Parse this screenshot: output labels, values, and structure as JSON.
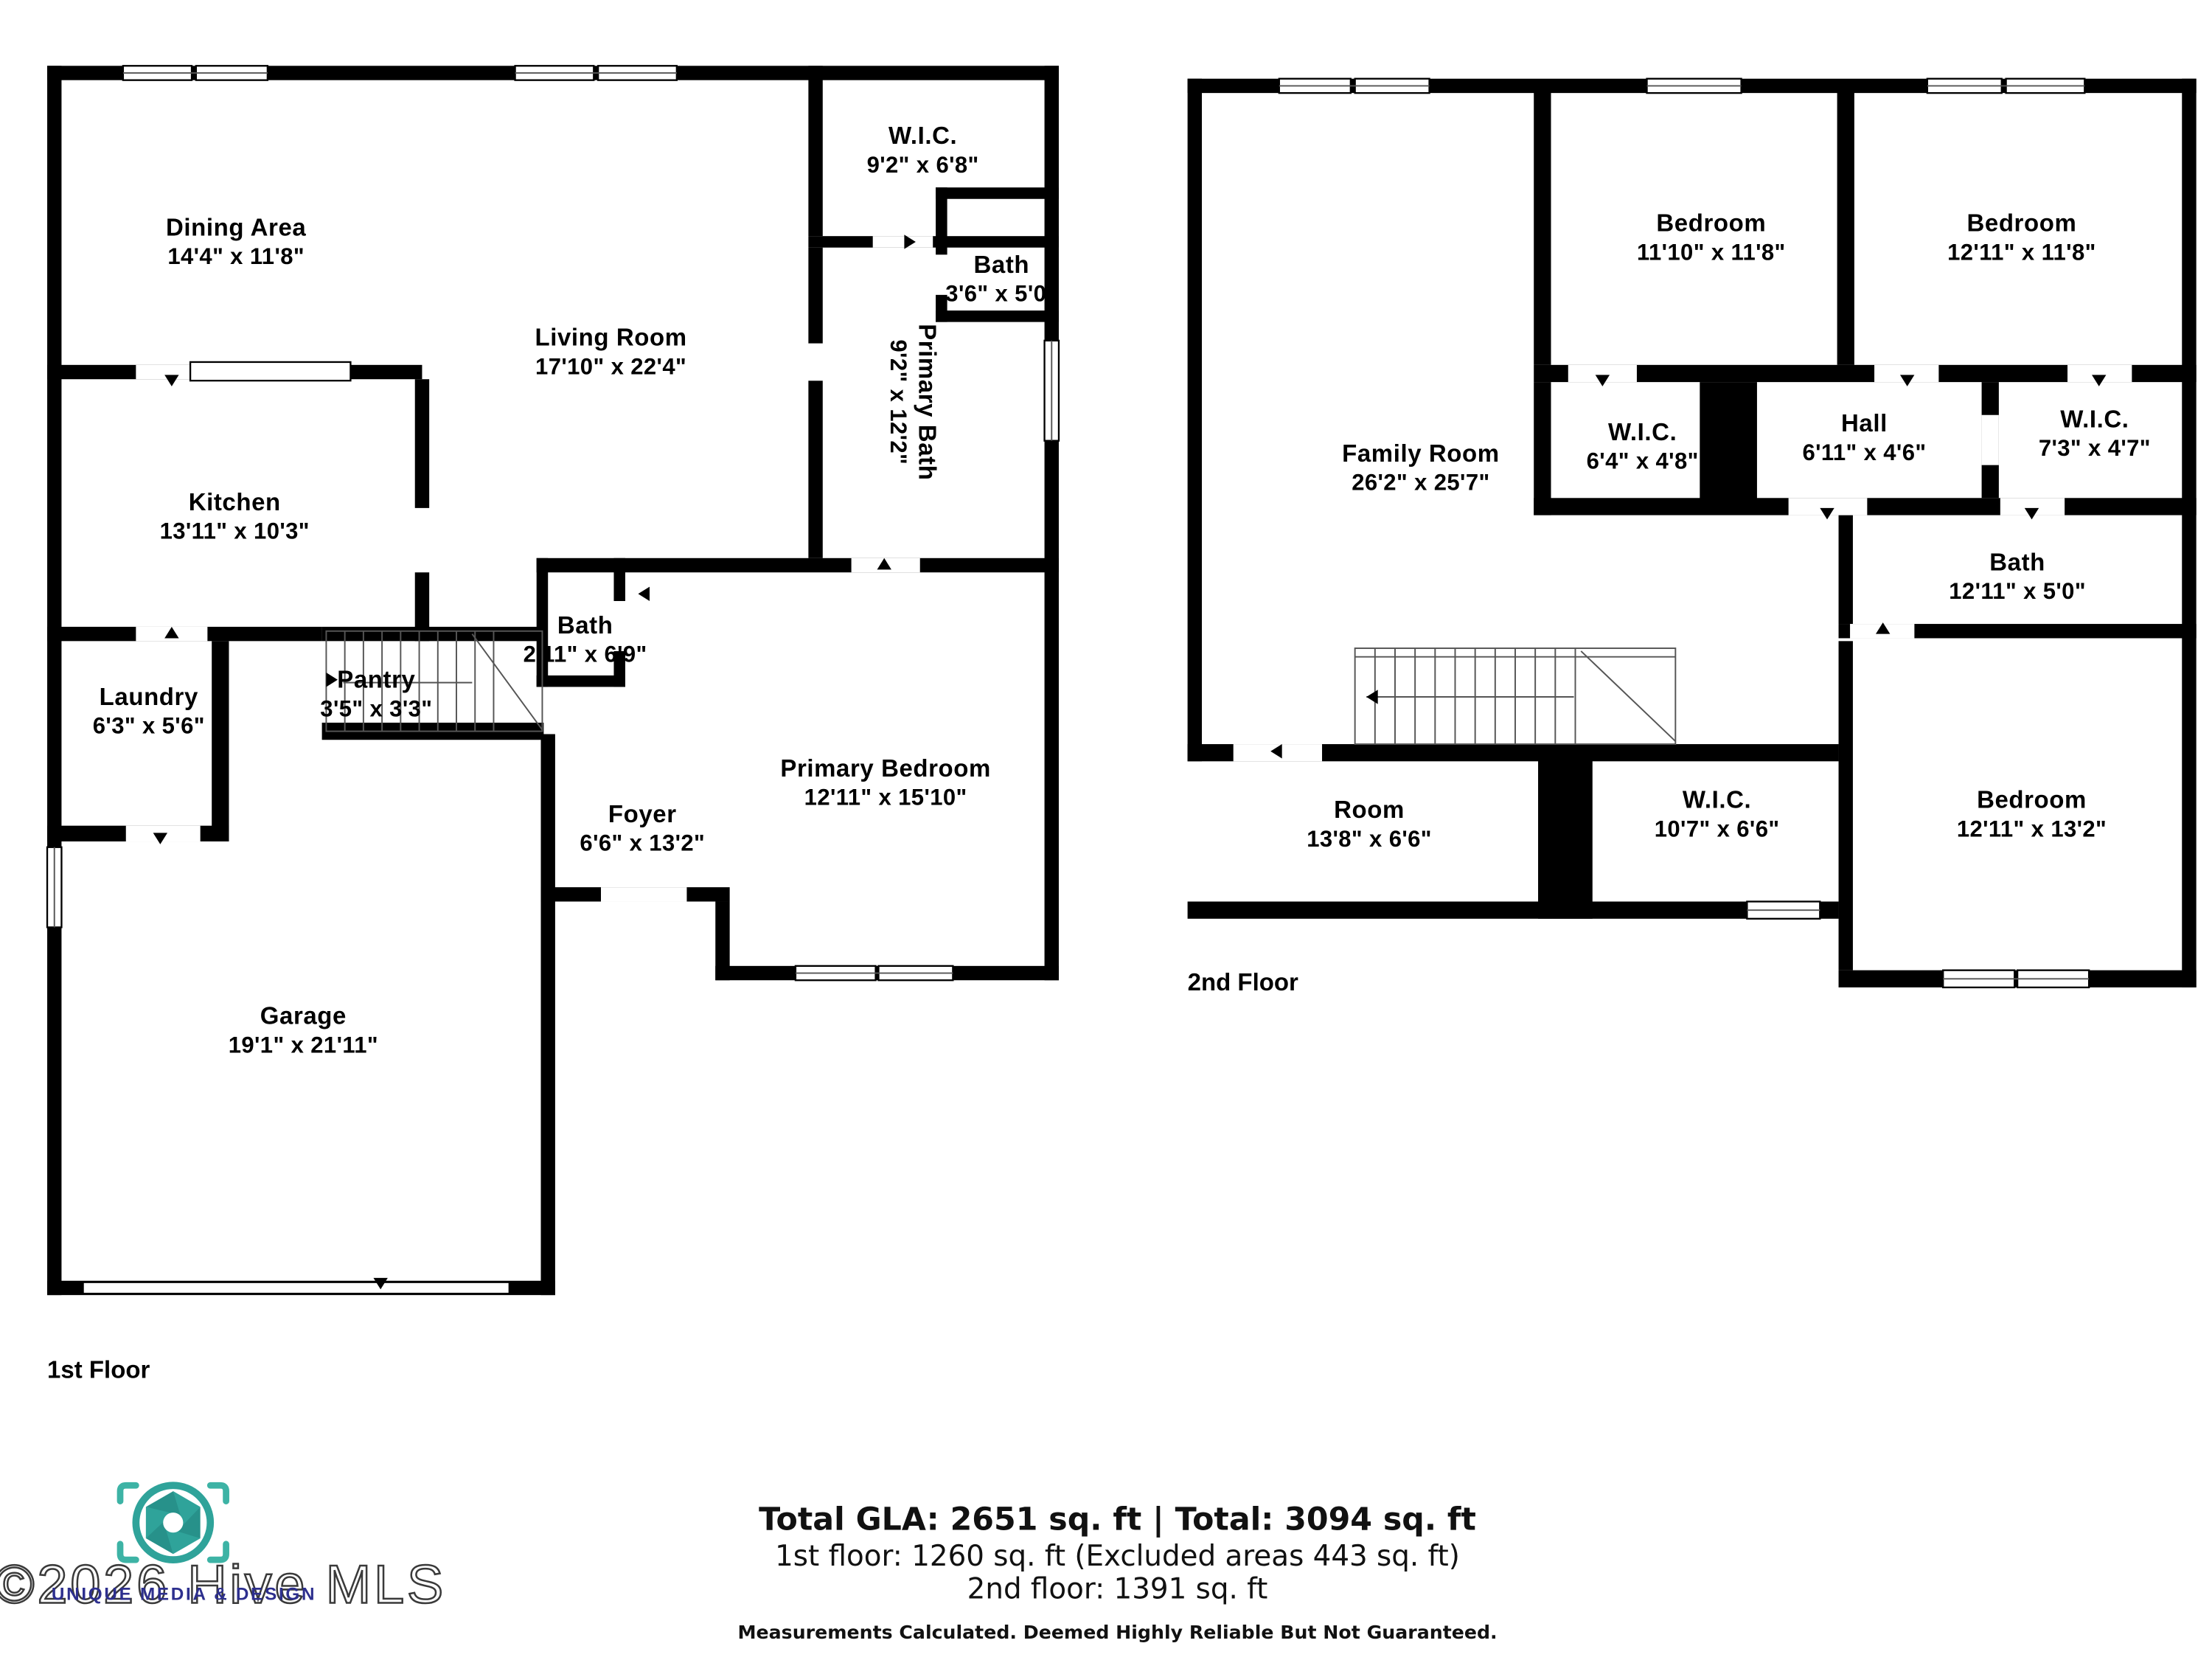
{
  "floors": [
    {
      "label": "1st Floor",
      "rooms": [
        {
          "name": "Dining Area",
          "dims": "14'4\" x 11'8\""
        },
        {
          "name": "Living Room",
          "dims": "17'10\" x 22'4\""
        },
        {
          "name": "W.I.C.",
          "dims": "9'2\" x 6'8\""
        },
        {
          "name": "Bath",
          "dims": "3'6\" x 5'0\""
        },
        {
          "name": "Primary Bath",
          "dims": "9'2\" x 12'2\""
        },
        {
          "name": "Kitchen",
          "dims": "13'11\" x 10'3\""
        },
        {
          "name": "Laundry",
          "dims": "6'3\" x 5'6\""
        },
        {
          "name": "Pantry",
          "dims": "3'5\" x 3'3\""
        },
        {
          "name": "Bath",
          "dims": "2'11\" x 6'9\""
        },
        {
          "name": "Foyer",
          "dims": "6'6\" x 13'2\""
        },
        {
          "name": "Primary Bedroom",
          "dims": "12'11\" x 15'10\""
        },
        {
          "name": "Garage",
          "dims": "19'1\" x 21'11\""
        }
      ]
    },
    {
      "label": "2nd Floor",
      "rooms": [
        {
          "name": "Family Room",
          "dims": "26'2\" x 25'7\""
        },
        {
          "name": "Bedroom",
          "dims": "11'10\" x 11'8\""
        },
        {
          "name": "Bedroom",
          "dims": "12'11\" x 11'8\""
        },
        {
          "name": "W.I.C.",
          "dims": "6'4\" x 4'8\""
        },
        {
          "name": "Hall",
          "dims": "6'11\" x 4'6\""
        },
        {
          "name": "W.I.C.",
          "dims": "7'3\" x 4'7\""
        },
        {
          "name": "Bath",
          "dims": "12'11\" x 5'0\""
        },
        {
          "name": "Room",
          "dims": "13'8\" x 6'6\""
        },
        {
          "name": "W.I.C.",
          "dims": "10'7\" x 6'6\""
        },
        {
          "name": "Bedroom",
          "dims": "12'11\" x 13'2\""
        }
      ]
    }
  ],
  "summary": {
    "total_line": "Total GLA: 2651 sq. ft | Total: 3094 sq. ft",
    "floor1_line": "1st floor: 1260 sq. ft (Excluded areas 443 sq. ft)",
    "floor2_line": "2nd floor: 1391 sq. ft",
    "disclaimer": "Measurements Calculated. Deemed Highly Reliable But Not Guaranteed."
  },
  "branding": {
    "watermark": "©2026 Hive MLS",
    "company": "UNIQUE MEDIA & DESIGN",
    "camera_icon": "aperture-viewfinder-icon",
    "accent_teal": "#2fa39a",
    "accent_navy": "#2d2f8e"
  }
}
